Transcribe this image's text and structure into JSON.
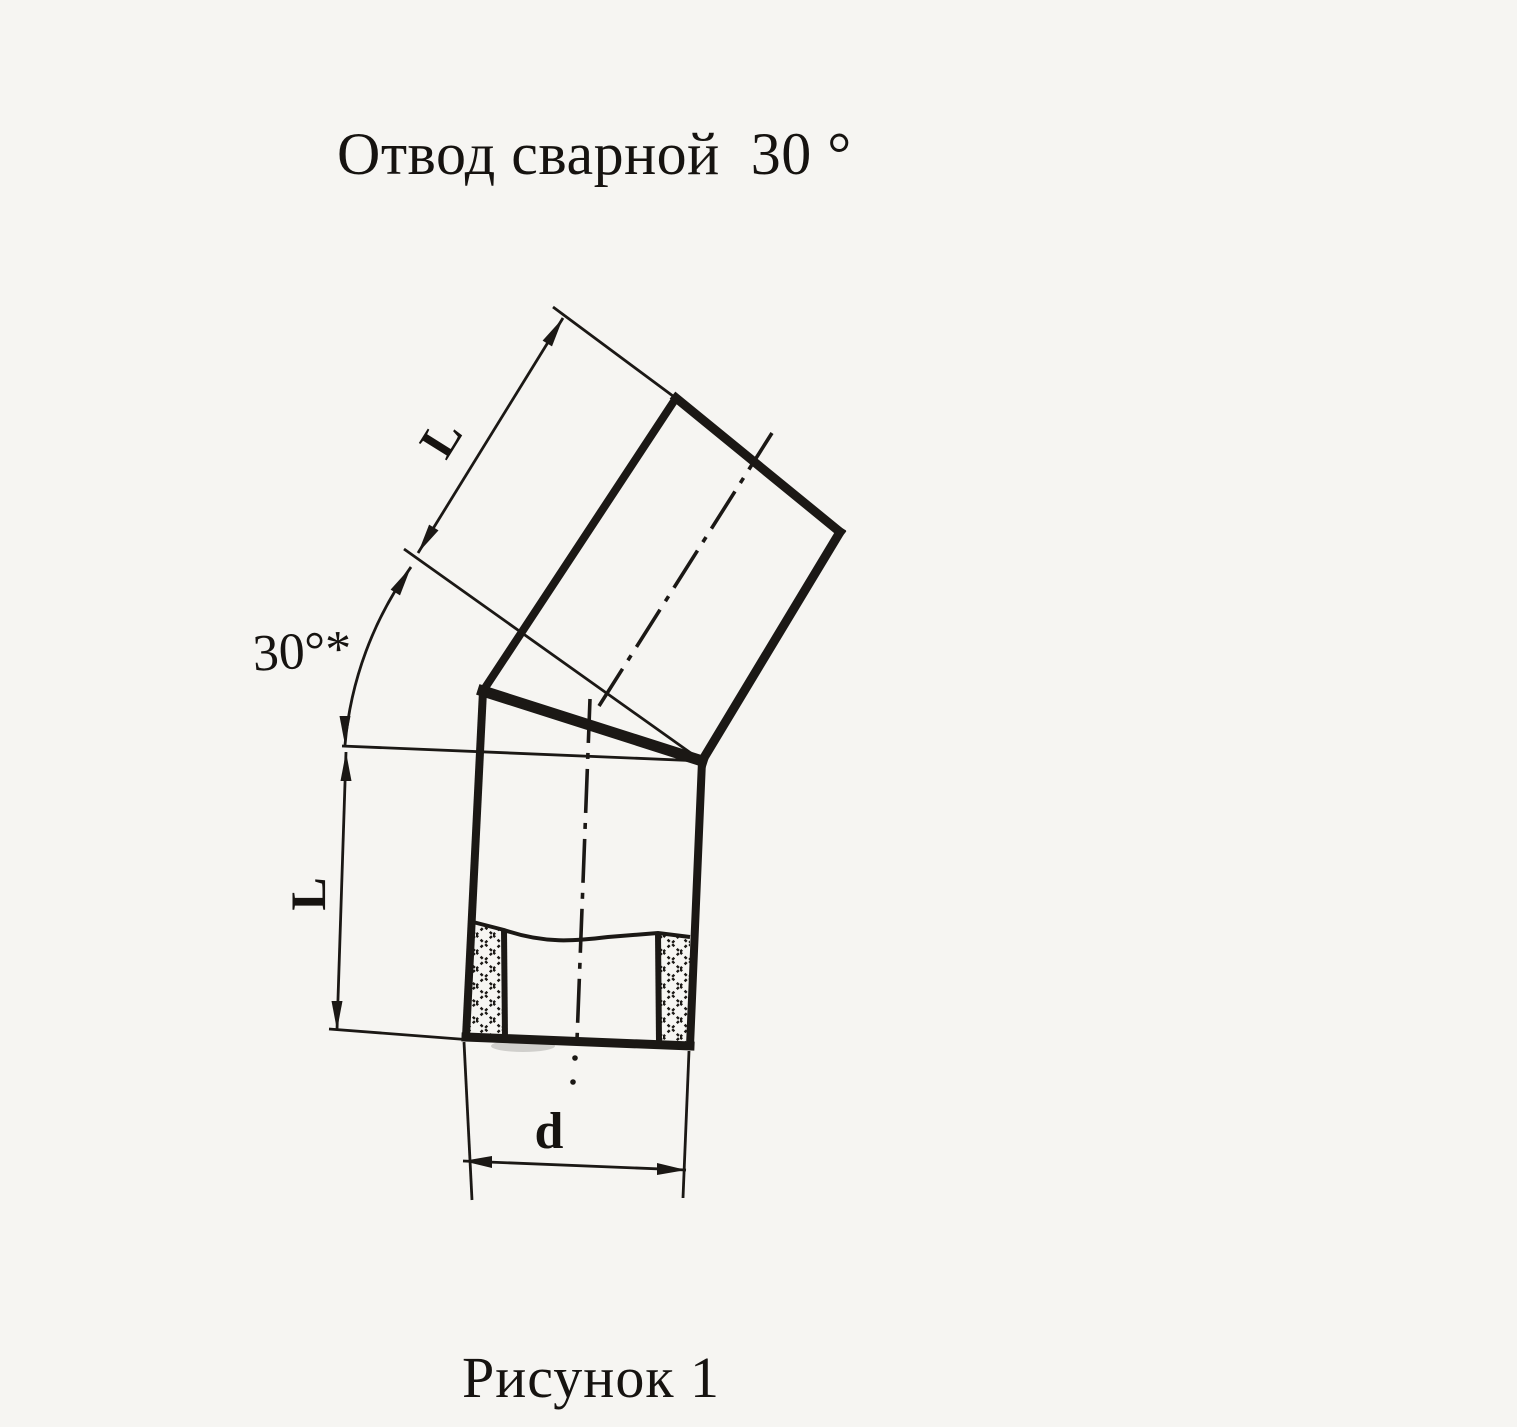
{
  "title": "Отвод сварной  30 °",
  "caption": "Рисунок 1",
  "drawing": {
    "description": "Technical drawing of a 30-degree welded pipe elbow (two mitered pipe segments joined by a weld seam, lower segment shown in section with hatched walls)",
    "labels": {
      "upper_segment_length": "L",
      "lower_segment_length": "L",
      "bend_angle": "30°*",
      "diameter": "d"
    },
    "colors": {
      "paper": "#f6f5f2",
      "ink": "#1b1815"
    }
  }
}
